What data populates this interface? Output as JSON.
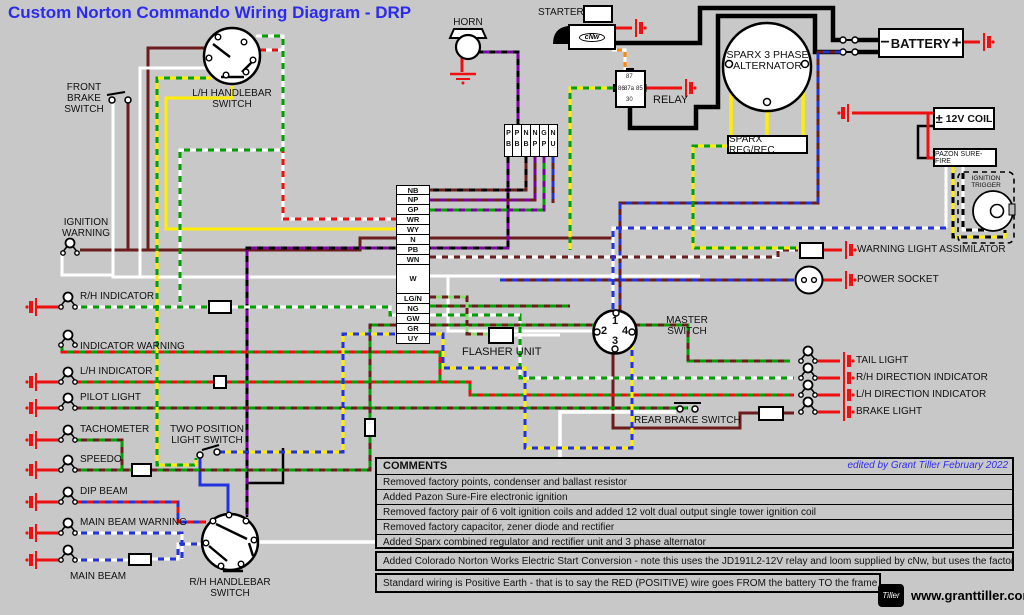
{
  "title": "Custom Norton Commando Wiring Diagram - DRP",
  "components": {
    "horn": "HORN",
    "starter": "STARTER",
    "starter_logo": "cNw",
    "relay": "RELAY",
    "relay_pins": {
      "p86": "86",
      "p87": "87",
      "p85": "85",
      "p87a": "87a",
      "p30": "30"
    },
    "alternator": "SPARX 3 PHASE ALTERNATOR",
    "reg_rec": "SPARX REG/REC",
    "battery": "BATTERY",
    "battery_minus": "−",
    "battery_plus": "+",
    "coil": "12V COIL",
    "coil_pm": "±",
    "pazon": "PAZON SURE-FIRE",
    "ignition_trigger": "IGNITION TRIGGER",
    "assimilator": "WARNING LIGHT ASSIMILATOR",
    "power_socket": "POWER SOCKET",
    "master_switch": "MASTER SWITCH",
    "ms_pins": {
      "p1": "1",
      "p2": "2",
      "p3": "3",
      "p4": "4"
    },
    "flasher": "FLASHER UNIT",
    "front_brake": "FRONT BRAKE SWITCH",
    "lh_handlebar": "L/H HANDLEBAR SWITCH",
    "rh_handlebar": "R/H HANDLEBAR SWITCH",
    "two_position": "TWO POSITION LIGHT SWITCH",
    "rear_brake": "REAR BRAKE SWITCH"
  },
  "left_items": {
    "ignition_warning": "IGNITION WARNING",
    "rh_indicator": "R/H INDICATOR",
    "indicator_warning": "INDICATOR WARNING",
    "lh_indicator": "L/H INDICATOR",
    "pilot": "PILOT LIGHT",
    "tachometer": "TACHOMETER",
    "speedo": "SPEEDO",
    "dip_beam": "DIP BEAM",
    "main_beam_warning": "MAIN BEAM WARNING",
    "main_beam": "MAIN BEAM"
  },
  "right_items": {
    "tail_light": "TAIL LIGHT",
    "rh_direction": "R/H DIRECTION INDICATOR",
    "lh_direction": "L/H DIRECTION INDICATOR",
    "brake_light": "BRAKE LIGHT"
  },
  "connector_vertical": [
    "NB",
    "NP",
    "GP",
    "WR",
    "WY",
    "N",
    "PB",
    "WN",
    "W",
    "LG/N",
    "NG",
    "GW",
    "GR",
    "UY"
  ],
  "connector_top": [
    "P B",
    "P B",
    "N B",
    "N P",
    "G P",
    "N U"
  ],
  "comments": {
    "header": "COMMENTS",
    "edited": "edited by Grant Tiller February 2022",
    "rows": [
      "Removed factory points, condenser and ballast resistor",
      "Added Pazon Sure-Fire electronic ignition",
      "Removed factory pair of 6 volt ignition coils and added 12 volt dual output single tower ignition coil",
      "Removed factory capacitor, zener diode and rectifier",
      "Added Sparx combined regulator and rectifier unit and 3 phase alternator",
      "Added Colorado Norton Works Electric Start Conversion - note this uses the JD191L2-12V relay and loom supplied by cNw, but uses the factory starter button",
      "Standard wiring is Positive Earth - that is to say the RED (POSITIVE) wire goes FROM the battery TO the frame"
    ]
  },
  "footer": {
    "logo": "Tiller",
    "website": "www.granttiller.com"
  },
  "colors": {
    "background": "#c8c8c8",
    "title": "#2b2bee",
    "wire_red": "#ee1010",
    "wire_brown": "#6b1d1d",
    "wire_green": "#00a000",
    "wire_yellow": "#ffee00",
    "wire_blue": "#2233dd",
    "wire_purple": "#7a00a0",
    "wire_orange": "#ff8800",
    "wire_lightgreen": "#8ade70",
    "wire_white": "#ffffff",
    "wire_black": "#000000"
  }
}
